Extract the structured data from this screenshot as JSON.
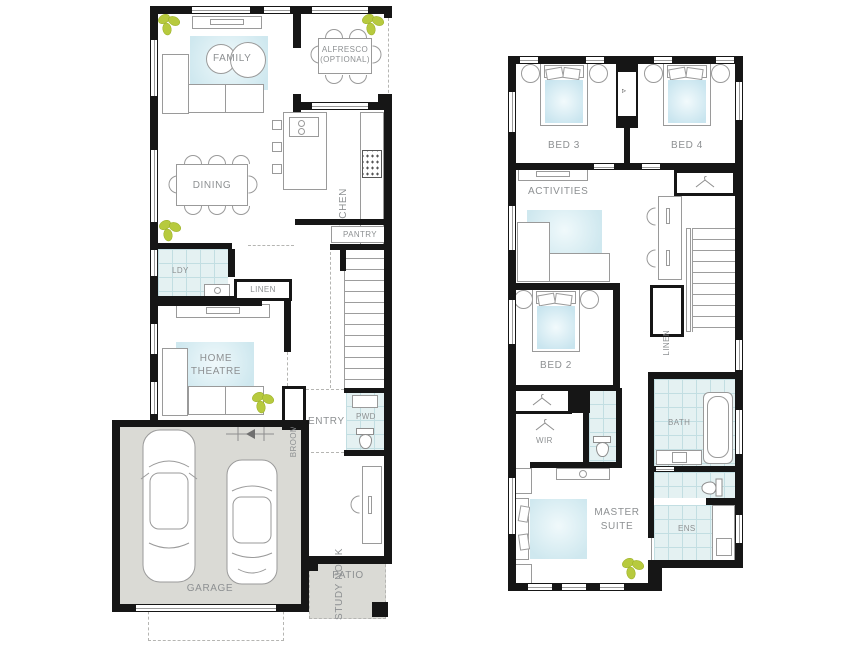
{
  "plan_type": "two-storey house floor plan",
  "colors": {
    "wall": "#161616",
    "tile_floor": "#e4f1f2",
    "tile_grid": "#c2dee2",
    "soft_blue_furnishing": "#cfe8ef",
    "hard_floor_grey": "#dadad5",
    "plant_green": "#b7ca3e",
    "label_grey": "#8d9092",
    "furniture_outline": "#9a9a9a"
  },
  "ground_floor": {
    "rooms": {
      "family": {
        "label": "FAMILY"
      },
      "alfresco": {
        "line1": "ALFRESCO",
        "line2": "(OPTIONAL)"
      },
      "dining": {
        "label": "DINING"
      },
      "kitchen": {
        "label": "KITCHEN"
      },
      "pantry": {
        "label": "PANTRY"
      },
      "laundry": {
        "label": "LDY"
      },
      "linen": {
        "label": "LINEN"
      },
      "home_theatre": {
        "line1": "HOME",
        "line2": "THEATRE"
      },
      "broom": {
        "label": "BROOM"
      },
      "entry": {
        "label": "ENTRY"
      },
      "powder": {
        "label": "PWD"
      },
      "study_nook": {
        "label": "STUDY NOOK"
      },
      "garage": {
        "label": "GARAGE"
      },
      "patio": {
        "label": "PATIO"
      }
    }
  },
  "first_floor": {
    "rooms": {
      "bed3": {
        "label": "BED 3"
      },
      "bed4": {
        "label": "BED 4"
      },
      "activities": {
        "label": "ACTIVITIES"
      },
      "bed2": {
        "label": "BED 2"
      },
      "linen": {
        "label": "LINEN"
      },
      "wir": {
        "label": "WIR"
      },
      "bath": {
        "label": "BATH"
      },
      "ens": {
        "label": "ENS"
      },
      "master_suite": {
        "line1": "MASTER",
        "line2": "SUITE"
      }
    }
  }
}
